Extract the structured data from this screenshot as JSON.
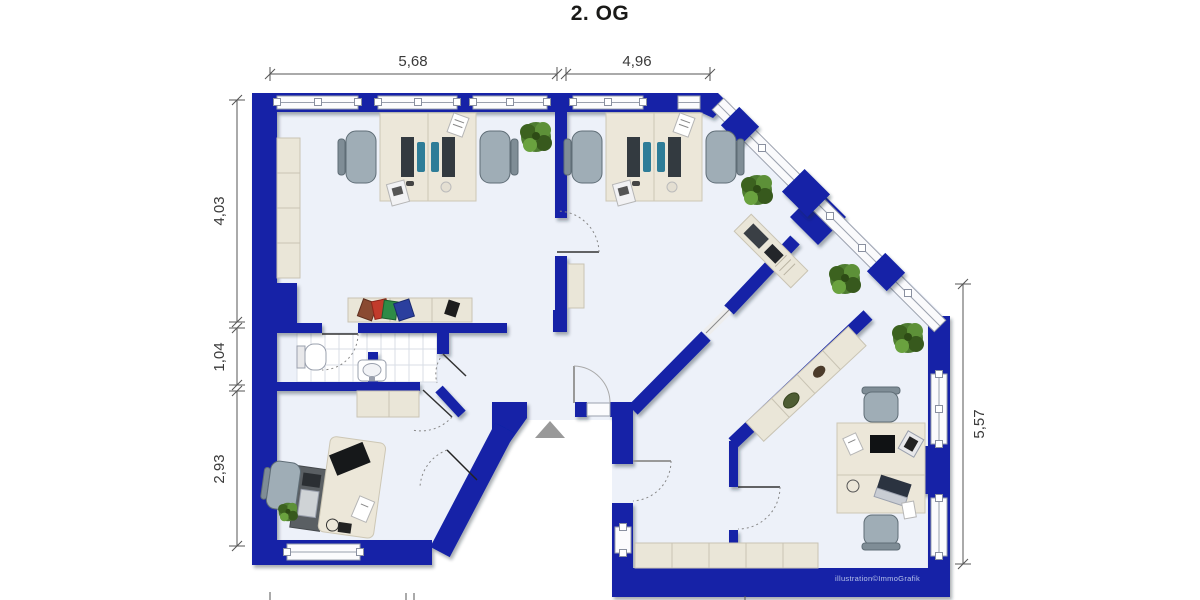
{
  "title": "2. OG",
  "credit": "illustration©ImmoGrafik",
  "dimensions": {
    "top_left_m": "5,68",
    "top_right_m": "4,96",
    "left_top_m": "4,03",
    "left_mid_m": "1,04",
    "left_bottom_m": "2,93",
    "right_m": "5,57"
  },
  "colors": {
    "wall_blue": "#1222a7",
    "wall_shadow": "#0a1470",
    "floor": "#edf1f9",
    "furniture_beige": "#ece7d9",
    "chair_gray": "#9fadb6",
    "monitor_dark": "#333a40",
    "keyboard_teal": "#2e7d98",
    "plant_green": "#4e7c31",
    "dimension_line": "#555555",
    "entrance_arrow": "#999999"
  },
  "features": [
    "double-workstation-desks",
    "office-chairs",
    "potted-plants",
    "sideboards",
    "wardrobe-cabinet",
    "wc-toilet",
    "wc-sink",
    "tiled-bathroom-floor",
    "entrance-arrow",
    "door-swing-arcs",
    "window-strips"
  ]
}
